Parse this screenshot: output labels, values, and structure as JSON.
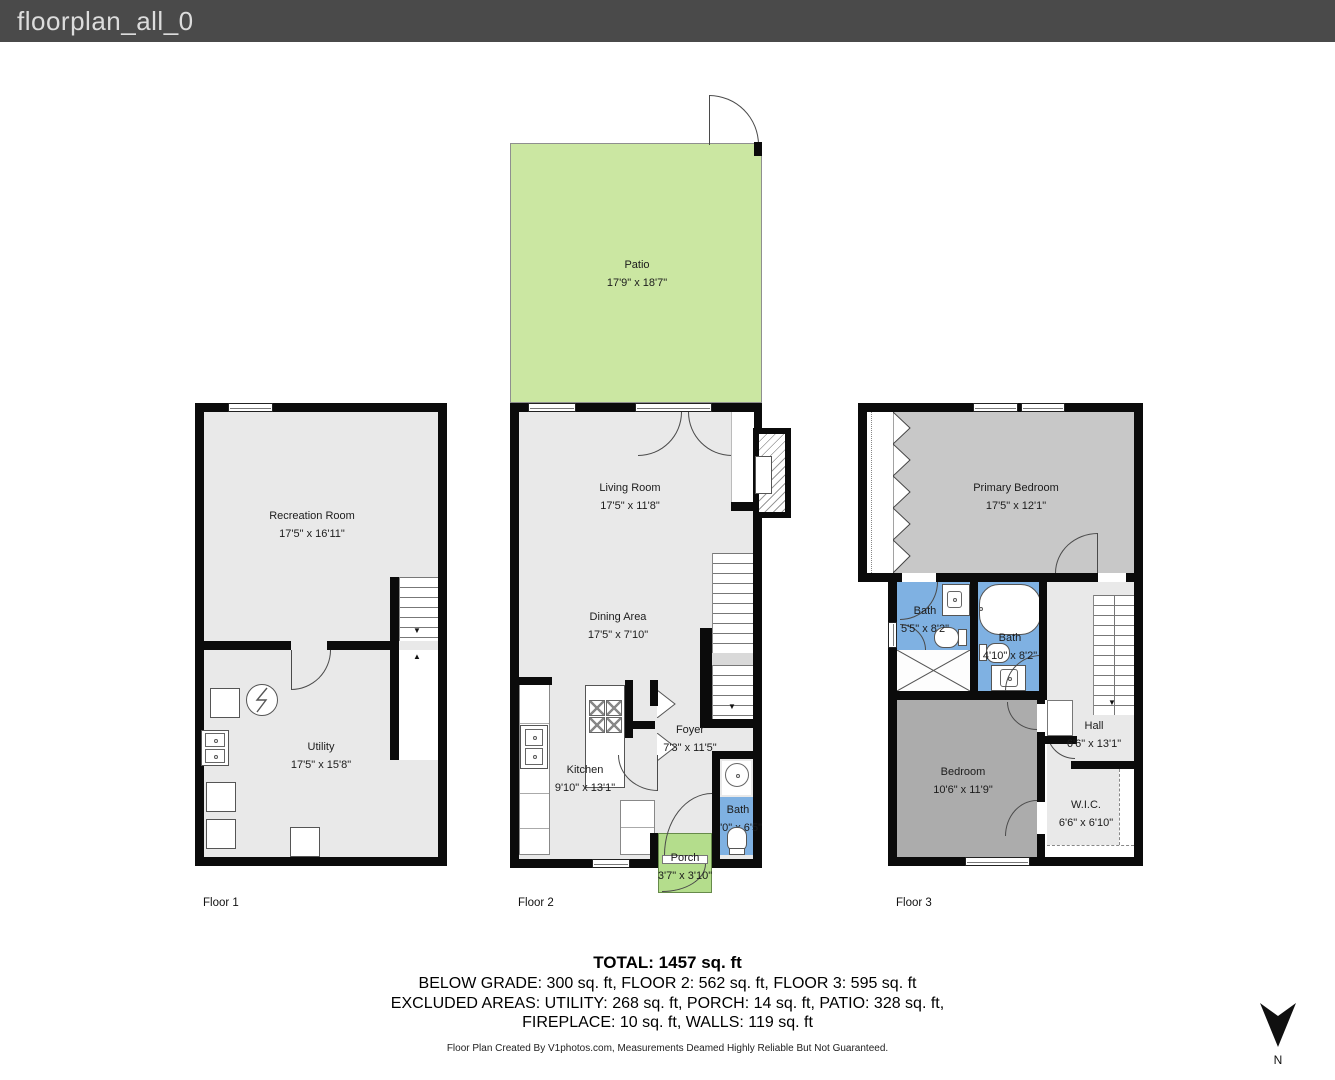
{
  "header": {
    "title": "floorplan_all_0"
  },
  "colors": {
    "header_bg": "#4a4a4a",
    "wall": "#0b0b0b",
    "floor_fill": "#e9e9e9",
    "patio_green": "#cbe7a2",
    "porch_green": "#b4dd8c",
    "bath_blue": "#7fb1e2",
    "primary_bedroom_gray": "#c8c8c8",
    "bedroom_gray": "#acacac"
  },
  "floors": [
    {
      "label": "Floor 1",
      "rooms": [
        {
          "name": "Recreation Room",
          "dims": "17'5\" x 16'11\""
        },
        {
          "name": "Utility",
          "dims": "17'5\" x 15'8\""
        }
      ]
    },
    {
      "label": "Floor 2",
      "rooms": [
        {
          "name": "Patio",
          "dims": "17'9\" x 18'7\""
        },
        {
          "name": "Living Room",
          "dims": "17'5\" x 11'8\""
        },
        {
          "name": "Dining Area",
          "dims": "17'5\" x 7'10\""
        },
        {
          "name": "Kitchen",
          "dims": "9'10\" x 13'1\""
        },
        {
          "name": "Foyer",
          "dims": "7'3\" x 11'5\""
        },
        {
          "name": "Bath",
          "dims": "3'0\" x 6'5\""
        },
        {
          "name": "Porch",
          "dims": "3'7\" x 3'10\""
        }
      ]
    },
    {
      "label": "Floor 3",
      "rooms": [
        {
          "name": "Primary Bedroom",
          "dims": "17'5\" x 12'1\""
        },
        {
          "name": "Bath",
          "dims": "5'5\" x 8'2\""
        },
        {
          "name": "Bath",
          "dims": "4'10\" x 8'2\""
        },
        {
          "name": "Hall",
          "dims": "6'6\" x 13'1\""
        },
        {
          "name": "Bedroom",
          "dims": "10'6\" x 11'9\""
        },
        {
          "name": "W.I.C.",
          "dims": "6'6\" x 6'10\""
        }
      ]
    }
  ],
  "summary": {
    "line1": "TOTAL: 1457 sq. ft",
    "line2": "BELOW GRADE: 300 sq. ft, FLOOR 2: 562 sq. ft, FLOOR 3: 595 sq. ft",
    "line3": "EXCLUDED AREAS: UTILITY: 268 sq. ft, PORCH: 14 sq. ft, PATIO: 328 sq. ft,",
    "line4": "FIREPLACE: 10 sq. ft, WALLS: 119 sq. ft"
  },
  "footer": {
    "credit": "Floor Plan Created By V1photos.com, Measurements Deamed Highly Reliable But Not Guaranteed."
  },
  "compass": {
    "label": "N"
  }
}
